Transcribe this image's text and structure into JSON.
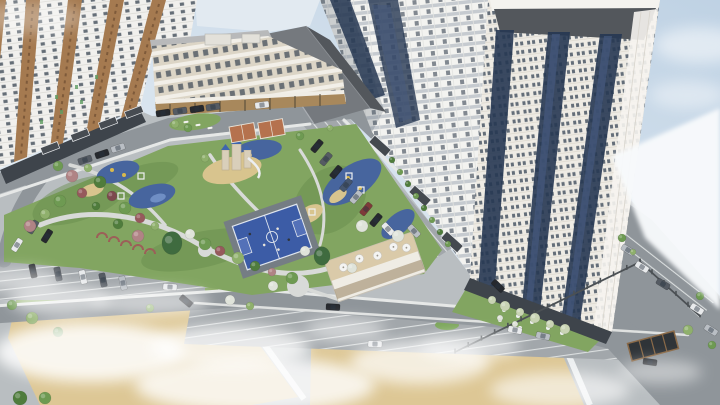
{
  "meta": {
    "type": "architectural-aerial-render",
    "description": "Aerial 3D rendering of a residential complex: three high-rise towers, a beige mid-rise school building, landscaped courtyard with playgrounds, basketball and street-sport courts, cafe pavilion, parking lots, internal roads and fog patches over lawns",
    "width": 720,
    "height": 405
  },
  "palette": {
    "sky": "#c4d4e4",
    "skyPale": "#e4edf3",
    "wedge": "#f8fafc",
    "ground": "#b9bec1",
    "road": "#8f959a",
    "parking": "#a2a7ab",
    "sidewalk": "#dfe1e0",
    "lawn": "#82a561",
    "lawnDark": "#678c4c",
    "field": "#ddc795",
    "sand": "#d8c48e",
    "playBlue": "#47659e",
    "playBlueLight": "#6f8ec4",
    "playYellow": "#d9b94d",
    "courtBlue": "#3c5ca6",
    "courtKey": "#5471b8",
    "courtLine": "#dfe5ee",
    "courtOrange": "#b5724e",
    "apron": "#757d84",
    "pathGray": "#d8dad8",
    "facadeWhite": "#f2f1ee",
    "facadeCream": "#eeebe4",
    "facadeShadow": "#c6cbd0",
    "windowDark": "#55606b",
    "glassNavy": "#263752",
    "glassBlue": "#45597d",
    "stripeBrown": "#a57a50",
    "beige": "#dcd5c6",
    "beigeRoof": "#b8b9ba",
    "wood": "#a8885c",
    "roofDark": "#53575c",
    "roofLight": "#75797e",
    "canopy": "#44494f",
    "baseBand": "#3e444b",
    "fence": "#4b5054",
    "carBlack": "#26292e",
    "carGray": "#555b63",
    "carSilver": "#b9bec4",
    "carWhite": "#e8eaec",
    "carRed": "#7e3a3a",
    "carBlue": "#46566e",
    "treeG1": "#4f7c3c",
    "treeG2": "#6e9a52",
    "treeG3": "#8fb06c",
    "treeG4": "#a9c285",
    "treeR1": "#96595c",
    "treeR2": "#b08385",
    "treeR3": "#7c4a4e",
    "spruce": "#3f6b3f",
    "treeWhite": "#dfe3da",
    "shrubLight": "#c9d4b4",
    "fog": "#ffffff",
    "boulder": "#eef0ee",
    "umbrella": "#f4f4f2"
  },
  "scene": {
    "buildings": [
      {
        "id": "left-tower",
        "label": "left residential tower, white facade with brown stripe accents"
      },
      {
        "id": "center-tower",
        "label": "central residential tower with balcony rows and navy glass strips"
      },
      {
        "id": "right-tower",
        "label": "right residential tower, cream facade, navy glazing, rounded corner, visible roof"
      },
      {
        "id": "beige-midrise",
        "label": "beige 5-storey building with wooden storefronts"
      },
      {
        "id": "podium-roof",
        "label": "large dark pitched roof of podium hall"
      },
      {
        "id": "cafe-pavilion",
        "label": "low cafe pavilion with rooftop terrace umbrellas"
      }
    ],
    "amenities": [
      {
        "id": "basketball-court",
        "label": "blue basketball court"
      },
      {
        "id": "street-courts",
        "label": "orange street-sport courts"
      },
      {
        "id": "castle-playground",
        "label": "castle playground on sand"
      },
      {
        "id": "rubber-playgrounds",
        "label": "blue rubber-surface playgrounds"
      },
      {
        "id": "pergola-walk",
        "label": "red trellis arch walk"
      },
      {
        "id": "stone-garden",
        "label": "white boulder garden"
      },
      {
        "id": "round-plaza",
        "label": "circular seating plaza"
      }
    ],
    "vehicles": [
      {
        "x": 85,
        "y": 160,
        "r": -18,
        "c": "carGray"
      },
      {
        "x": 102,
        "y": 154,
        "r": -18,
        "c": "carBlack"
      },
      {
        "x": 118,
        "y": 148,
        "r": -18,
        "c": "carSilver"
      },
      {
        "x": 163,
        "y": 113,
        "r": -9,
        "c": "carBlack"
      },
      {
        "x": 180,
        "y": 111,
        "r": -9,
        "c": "carGray"
      },
      {
        "x": 197,
        "y": 109,
        "r": -9,
        "c": "carBlack"
      },
      {
        "x": 213,
        "y": 107,
        "r": -9,
        "c": "carGray"
      },
      {
        "x": 262,
        "y": 105,
        "r": -7,
        "c": "carWhite"
      },
      {
        "x": 33,
        "y": 227,
        "r": -58,
        "c": "carGray"
      },
      {
        "x": 47,
        "y": 236,
        "r": -58,
        "c": "carBlack"
      },
      {
        "x": 17,
        "y": 245,
        "r": -58,
        "c": "carWhite"
      },
      {
        "x": 317,
        "y": 146,
        "r": -50,
        "c": "carBlack"
      },
      {
        "x": 326,
        "y": 159,
        "r": -50,
        "c": "carGray"
      },
      {
        "x": 336,
        "y": 172,
        "r": -50,
        "c": "carBlack"
      },
      {
        "x": 346,
        "y": 185,
        "r": -50,
        "c": "carBlue"
      },
      {
        "x": 356,
        "y": 197,
        "r": -50,
        "c": "carSilver"
      },
      {
        "x": 366,
        "y": 209,
        "r": -50,
        "c": "carRed"
      },
      {
        "x": 376,
        "y": 220,
        "r": -50,
        "c": "carBlack"
      },
      {
        "x": 388,
        "y": 229,
        "r": 47,
        "c": "carWhite"
      },
      {
        "x": 414,
        "y": 231,
        "r": 47,
        "c": "carSilver"
      },
      {
        "x": 498,
        "y": 286,
        "r": 44,
        "c": "carBlack"
      },
      {
        "x": 628,
        "y": 250,
        "r": 32,
        "c": "carSilver"
      },
      {
        "x": 642,
        "y": 267,
        "r": 32,
        "c": "carWhite"
      },
      {
        "x": 663,
        "y": 284,
        "r": 32,
        "c": "carGray"
      },
      {
        "x": 697,
        "y": 309,
        "r": 32,
        "c": "carWhite"
      },
      {
        "x": 711,
        "y": 330,
        "r": 32,
        "c": "carSilver"
      },
      {
        "x": 650,
        "y": 362,
        "r": 8,
        "c": "carBlack"
      },
      {
        "x": 33,
        "y": 271,
        "r": 78,
        "c": "carBlack"
      },
      {
        "x": 58,
        "y": 274,
        "r": 78,
        "c": "carGray"
      },
      {
        "x": 83,
        "y": 277,
        "r": 78,
        "c": "carWhite"
      },
      {
        "x": 103,
        "y": 280,
        "r": 78,
        "c": "carGray"
      },
      {
        "x": 123,
        "y": 283,
        "r": 78,
        "c": "carSilver"
      },
      {
        "x": 170,
        "y": 287,
        "r": 4,
        "c": "carWhite"
      },
      {
        "x": 186,
        "y": 301,
        "r": 40,
        "c": "carBlack"
      },
      {
        "x": 333,
        "y": 307,
        "r": 3,
        "c": "carBlack"
      },
      {
        "x": 375,
        "y": 344,
        "r": 2,
        "c": "carWhite"
      },
      {
        "x": 515,
        "y": 330,
        "r": 12,
        "c": "carWhite"
      },
      {
        "x": 543,
        "y": 336,
        "r": 12,
        "c": "carSilver"
      }
    ],
    "trees": [
      {
        "x": 58,
        "y": 166,
        "s": 5,
        "c": "treeG2"
      },
      {
        "x": 72,
        "y": 176,
        "s": 6,
        "c": "treeR2"
      },
      {
        "x": 88,
        "y": 168,
        "s": 4,
        "c": "treeG3"
      },
      {
        "x": 100,
        "y": 182,
        "s": 6,
        "c": "treeG1"
      },
      {
        "x": 82,
        "y": 193,
        "s": 5,
        "c": "treeR1"
      },
      {
        "x": 60,
        "y": 201,
        "s": 6,
        "c": "treeG2"
      },
      {
        "x": 45,
        "y": 214,
        "s": 5,
        "c": "treeG3"
      },
      {
        "x": 30,
        "y": 226,
        "s": 6,
        "c": "treeR2"
      },
      {
        "x": 96,
        "y": 206,
        "s": 4,
        "c": "treeG1"
      },
      {
        "x": 112,
        "y": 196,
        "s": 5,
        "c": "treeR3"
      },
      {
        "x": 125,
        "y": 208,
        "s": 6,
        "c": "treeG2"
      },
      {
        "x": 140,
        "y": 218,
        "s": 5,
        "c": "treeR1"
      },
      {
        "x": 155,
        "y": 226,
        "s": 4,
        "c": "treeG3"
      },
      {
        "x": 118,
        "y": 224,
        "s": 5,
        "c": "treeG1"
      },
      {
        "x": 138,
        "y": 236,
        "s": 6,
        "c": "treeR2"
      },
      {
        "x": 190,
        "y": 234,
        "s": 5,
        "c": "treeWhite"
      },
      {
        "x": 205,
        "y": 244,
        "s": 6,
        "c": "treeG2"
      },
      {
        "x": 220,
        "y": 251,
        "s": 5,
        "c": "treeR1"
      },
      {
        "x": 238,
        "y": 258,
        "s": 6,
        "c": "treeG3"
      },
      {
        "x": 255,
        "y": 266,
        "s": 5,
        "c": "treeG1"
      },
      {
        "x": 272,
        "y": 272,
        "s": 4,
        "c": "treeR2"
      },
      {
        "x": 292,
        "y": 278,
        "s": 6,
        "c": "treeG2"
      },
      {
        "x": 305,
        "y": 251,
        "s": 5,
        "c": "treeWhite"
      },
      {
        "x": 362,
        "y": 226,
        "s": 6,
        "c": "treeWhite"
      },
      {
        "x": 398,
        "y": 236,
        "s": 6,
        "c": "treeWhite"
      },
      {
        "x": 352,
        "y": 268,
        "s": 5,
        "c": "treeWhite"
      },
      {
        "x": 273,
        "y": 286,
        "s": 5,
        "c": "treeWhite"
      },
      {
        "x": 175,
        "y": 124,
        "s": 4,
        "c": "treeG3"
      },
      {
        "x": 188,
        "y": 128,
        "s": 4,
        "c": "treeG2"
      },
      {
        "x": 392,
        "y": 160,
        "s": 3,
        "c": "treeG1"
      },
      {
        "x": 400,
        "y": 172,
        "s": 3,
        "c": "treeG2"
      },
      {
        "x": 408,
        "y": 184,
        "s": 3,
        "c": "treeG1"
      },
      {
        "x": 416,
        "y": 196,
        "s": 3,
        "c": "treeG2"
      },
      {
        "x": 424,
        "y": 208,
        "s": 3,
        "c": "treeG1"
      },
      {
        "x": 432,
        "y": 220,
        "s": 3,
        "c": "treeG2"
      },
      {
        "x": 440,
        "y": 232,
        "s": 3,
        "c": "treeG1"
      },
      {
        "x": 448,
        "y": 244,
        "s": 3,
        "c": "treeG2"
      },
      {
        "x": 622,
        "y": 238,
        "s": 4,
        "c": "treeG2"
      },
      {
        "x": 633,
        "y": 252,
        "s": 3,
        "c": "treeG3"
      },
      {
        "x": 700,
        "y": 296,
        "s": 4,
        "c": "treeG2"
      },
      {
        "x": 688,
        "y": 330,
        "s": 5,
        "c": "treeG3"
      },
      {
        "x": 712,
        "y": 345,
        "s": 4,
        "c": "treeG2"
      },
      {
        "x": 12,
        "y": 305,
        "s": 5,
        "c": "treeG2"
      },
      {
        "x": 32,
        "y": 318,
        "s": 6,
        "c": "treeG3"
      },
      {
        "x": 58,
        "y": 332,
        "s": 5,
        "c": "treeG2"
      },
      {
        "x": 150,
        "y": 308,
        "s": 4,
        "c": "treeG3"
      },
      {
        "x": 230,
        "y": 300,
        "s": 5,
        "c": "treeWhite"
      },
      {
        "x": 250,
        "y": 306,
        "s": 4,
        "c": "treeG3"
      },
      {
        "x": 20,
        "y": 398,
        "s": 7,
        "c": "treeG1"
      },
      {
        "x": 45,
        "y": 398,
        "s": 6,
        "c": "treeG2"
      },
      {
        "x": 205,
        "y": 158,
        "s": 4,
        "c": "treeG3"
      },
      {
        "x": 300,
        "y": 136,
        "s": 4,
        "c": "treeG2"
      },
      {
        "x": 330,
        "y": 128,
        "s": 3,
        "c": "treeG3"
      },
      {
        "x": 172,
        "y": 243,
        "s": 10,
        "c": "spruce"
      },
      {
        "x": 322,
        "y": 256,
        "s": 8,
        "c": "spruce"
      },
      {
        "x": 492,
        "y": 300,
        "s": 4,
        "c": "shrubLight"
      },
      {
        "x": 505,
        "y": 306,
        "s": 5,
        "c": "shrubLight"
      },
      {
        "x": 520,
        "y": 312,
        "s": 4,
        "c": "shrubLight"
      },
      {
        "x": 535,
        "y": 318,
        "s": 5,
        "c": "shrubLight"
      },
      {
        "x": 550,
        "y": 324,
        "s": 4,
        "c": "shrubLight"
      },
      {
        "x": 565,
        "y": 329,
        "s": 5,
        "c": "shrubLight"
      },
      {
        "x": 500,
        "y": 318,
        "s": 3,
        "c": "treeWhite"
      },
      {
        "x": 515,
        "y": 324,
        "s": 3,
        "c": "treeWhite"
      }
    ],
    "fog": [
      {
        "x": 90,
        "y": 352,
        "rx": 95,
        "ry": 30,
        "o": 0.85
      },
      {
        "x": 255,
        "y": 385,
        "rx": 120,
        "ry": 28,
        "o": 0.8
      },
      {
        "x": 420,
        "y": 362,
        "rx": 70,
        "ry": 22,
        "o": 0.7
      },
      {
        "x": 150,
        "y": 302,
        "rx": 60,
        "ry": 14,
        "o": 0.55
      },
      {
        "x": 20,
        "y": 280,
        "rx": 40,
        "ry": 12,
        "o": 0.5
      },
      {
        "x": 560,
        "y": 390,
        "rx": 70,
        "ry": 18,
        "o": 0.6
      },
      {
        "x": 660,
        "y": 372,
        "rx": 42,
        "ry": 12,
        "o": 0.45
      },
      {
        "x": 345,
        "y": 330,
        "rx": 40,
        "ry": 12,
        "o": 0.5
      },
      {
        "x": 470,
        "y": 347,
        "rx": 50,
        "ry": 14,
        "o": 0.55
      },
      {
        "x": 230,
        "y": 347,
        "rx": 80,
        "ry": 22,
        "o": 0.75
      },
      {
        "x": 60,
        "y": 300,
        "rx": 50,
        "ry": 16,
        "o": 0.6
      },
      {
        "x": 30,
        "y": 18,
        "rx": 55,
        "ry": 16,
        "o": 0.3
      },
      {
        "x": 700,
        "y": 45,
        "rx": 45,
        "ry": 18,
        "o": 0.5
      },
      {
        "x": 688,
        "y": 95,
        "rx": 38,
        "ry": 14,
        "o": 0.4
      }
    ],
    "umbrellas": [
      [
        -30,
        -10
      ],
      [
        -12,
        -13
      ],
      [
        6,
        -10
      ],
      [
        24,
        -13
      ],
      [
        36,
        -8
      ]
    ],
    "players": [
      [
        -10,
        5,
        "light"
      ],
      [
        8,
        -6,
        "light"
      ],
      [
        15,
        8,
        "dark"
      ],
      [
        -20,
        -10,
        "dark"
      ],
      [
        2,
        14,
        "light"
      ]
    ],
    "boulders": [
      [
        492,
        302
      ],
      [
        504,
        310
      ],
      [
        518,
        316
      ],
      [
        532,
        322
      ],
      [
        548,
        328
      ],
      [
        562,
        333
      ],
      [
        500,
        320
      ],
      [
        520,
        328
      ]
    ],
    "fences": [
      {
        "x1": 455,
        "y1": 352,
        "x2": 640,
        "y2": 262,
        "posts": 14
      },
      {
        "x1": 640,
        "y1": 262,
        "x2": 700,
        "y2": 316,
        "posts": 5
      }
    ],
    "pergolaArches": [
      [
        102,
        236
      ],
      [
        114,
        240
      ],
      [
        126,
        244
      ],
      [
        138,
        248
      ],
      [
        150,
        252
      ]
    ],
    "loungers": [
      [
        186,
        122
      ],
      [
        198,
        125
      ],
      [
        210,
        128
      ]
    ],
    "greenBalconyDots": [
      [
        55,
        95
      ],
      [
        75,
        85
      ],
      [
        95,
        75
      ],
      [
        40,
        120
      ],
      [
        60,
        110
      ],
      [
        80,
        100
      ]
    ]
  }
}
